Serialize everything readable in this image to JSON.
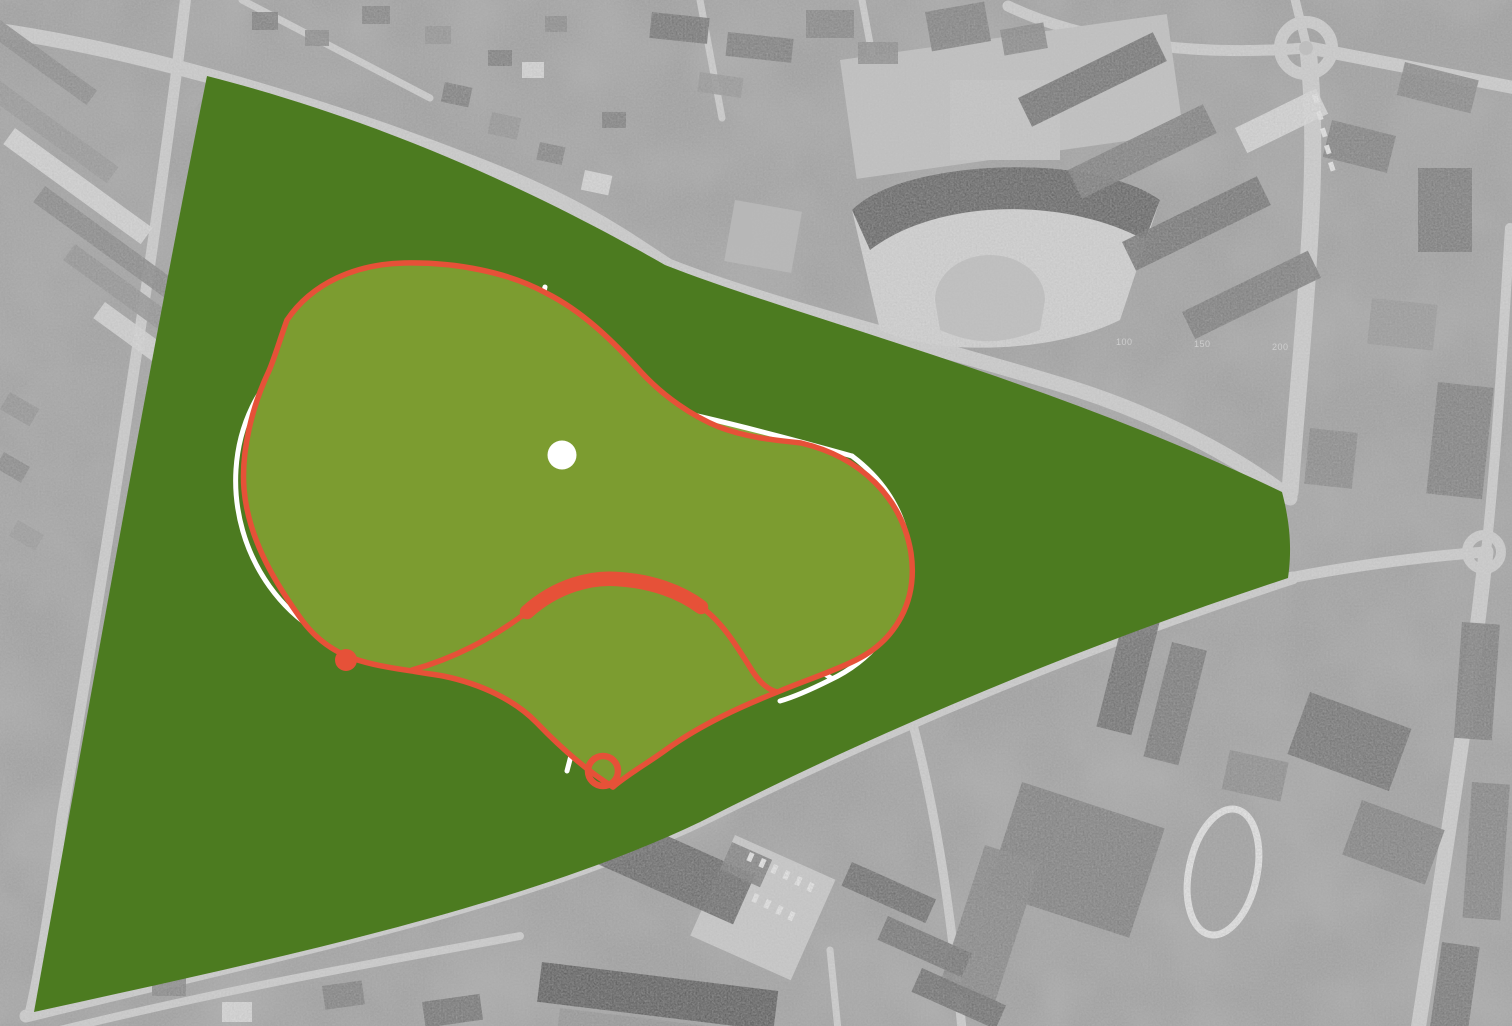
{
  "document": {
    "type": "landscape-masterplan-overlay",
    "description": "Black-and-white aerial orthophoto of a town with a dark green triangular park-site polygon and an organic two-lobed park design plan drawn over it: bright and olive lawns, a white path network with a circular node, and a red loop outline with a thick red arc, a small red ring and a red marker dot."
  },
  "palette": {
    "site_green": "#4c7b20",
    "plan_olive": "#7c9c30",
    "plan_olive_light": "#8aa73c",
    "plan_olive_dark": "#6f9227",
    "plan_bright": "#a6c937",
    "plan_red": "#e65138",
    "path_white": "#ffffff",
    "photo_gray": "#b3b3b3",
    "photo_dark": "#5f5f5f",
    "photo_light": "#dcdcdc",
    "road_gray": "#d6d6d6"
  },
  "features": {
    "site_polygon": "park-site-area",
    "plan_blob": "park-design-plan",
    "central_node": "path-node-circle",
    "red_arc": "thick-red-activity-arc",
    "red_ring": "small-red-ring",
    "red_dot": "red-entrance-dot",
    "roundabout": "roundabout-intersection",
    "running_track": "athletics-track-oval",
    "concert_hall": "fan-shaped-hall"
  },
  "photo_labels": {
    "a": "100",
    "b": "150",
    "c": "200"
  }
}
